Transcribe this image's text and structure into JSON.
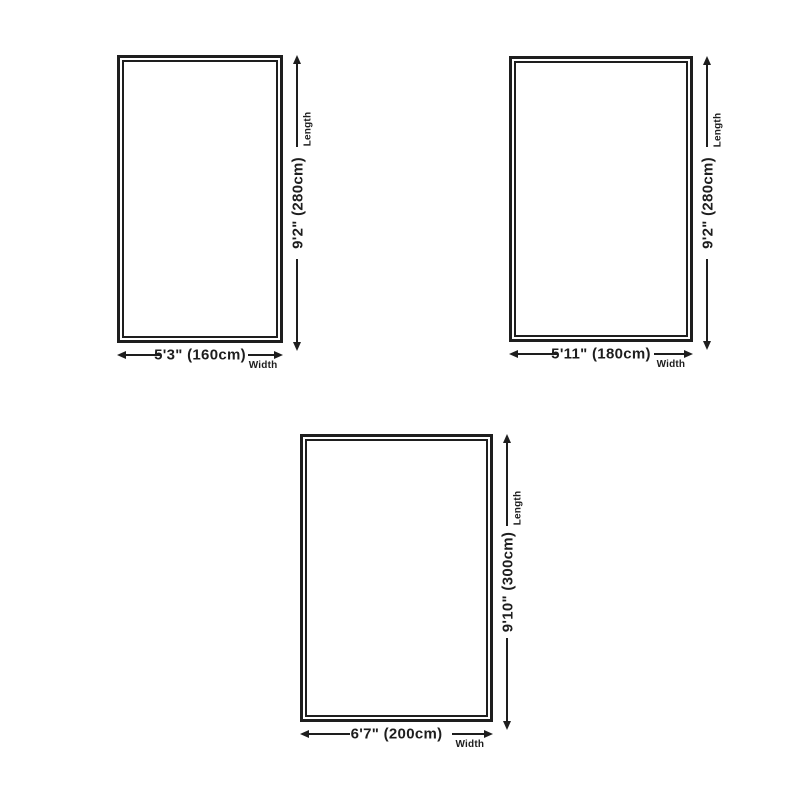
{
  "canvas": {
    "background": "#ffffff",
    "ink_color": "#1e1e1e"
  },
  "diagrams": [
    {
      "id": "size-160x280",
      "width_label": "5'3\" (160cm)",
      "length_label": "9'2\" (280cm)",
      "width_caption": "Width",
      "length_caption": "Length",
      "width_cm": 160,
      "length_cm": 280
    },
    {
      "id": "size-180x280",
      "width_label": "5'11\" (180cm)",
      "length_label": "9'2\" (280cm)",
      "width_caption": "Width",
      "length_caption": "Length",
      "width_cm": 180,
      "length_cm": 280
    },
    {
      "id": "size-200x300",
      "width_label": "6'7\" (200cm)",
      "length_label": "9'10\" (300cm)",
      "width_caption": "Width",
      "length_caption": "Length",
      "width_cm": 200,
      "length_cm": 300
    }
  ]
}
